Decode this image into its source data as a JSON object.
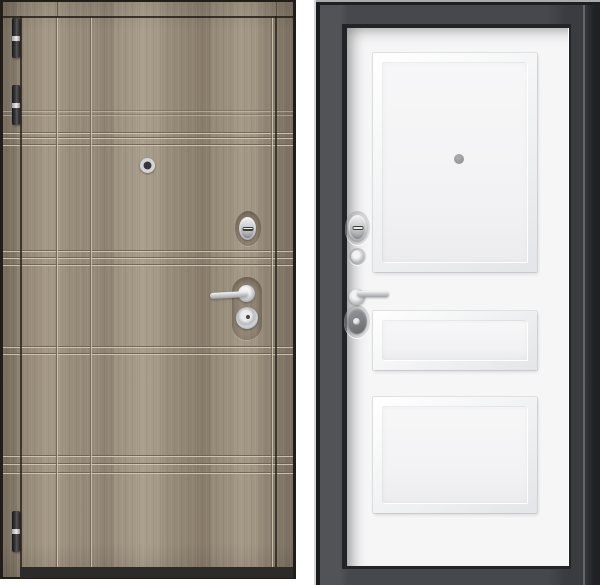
{
  "image": {
    "background": "#ffffff",
    "content": "product photo of a steel entry door shown from both sides"
  },
  "exterior_door": {
    "label": "exterior side: gray-oak wood-laminate door leaf with frame",
    "hinge_count": 3,
    "hardware": [
      "peephole",
      "thumbturn-cylinder-lock",
      "lever-handle",
      "round-lock-escutcheon"
    ],
    "groove_pattern": "grid of horizontal groove bands and vertical grooves",
    "colors": {
      "wood_base": "#9a8e7d",
      "wood_dark": "#847763",
      "wood_light": "#b3a795",
      "groove_light": "#d6ccbb",
      "groove_dark": "#6b6052",
      "edge": "#211d18",
      "threshold": "#2c2b29",
      "hinge_dark": "#33353a",
      "hinge_chrome": "#c7c9cb"
    }
  },
  "interior_door": {
    "label": "interior side: white three-panel door leaf in dark gray frame",
    "panel_count": 3,
    "hardware": [
      "peephole",
      "thumbturn-cylinder-lock",
      "small-cylinder",
      "lever-handle",
      "oval-lock-escutcheon"
    ],
    "colors": {
      "frame": "#46484c",
      "frame_dark": "#232427",
      "frame_highlight": "#d4d5d6",
      "leaf": "#f6f6f7",
      "panel_shadow": "#e0e1e4",
      "hardware_chrome": "#c9cccf",
      "escutcheon_gray": "#7d7f82",
      "peephole_gray": "#98999b"
    }
  }
}
